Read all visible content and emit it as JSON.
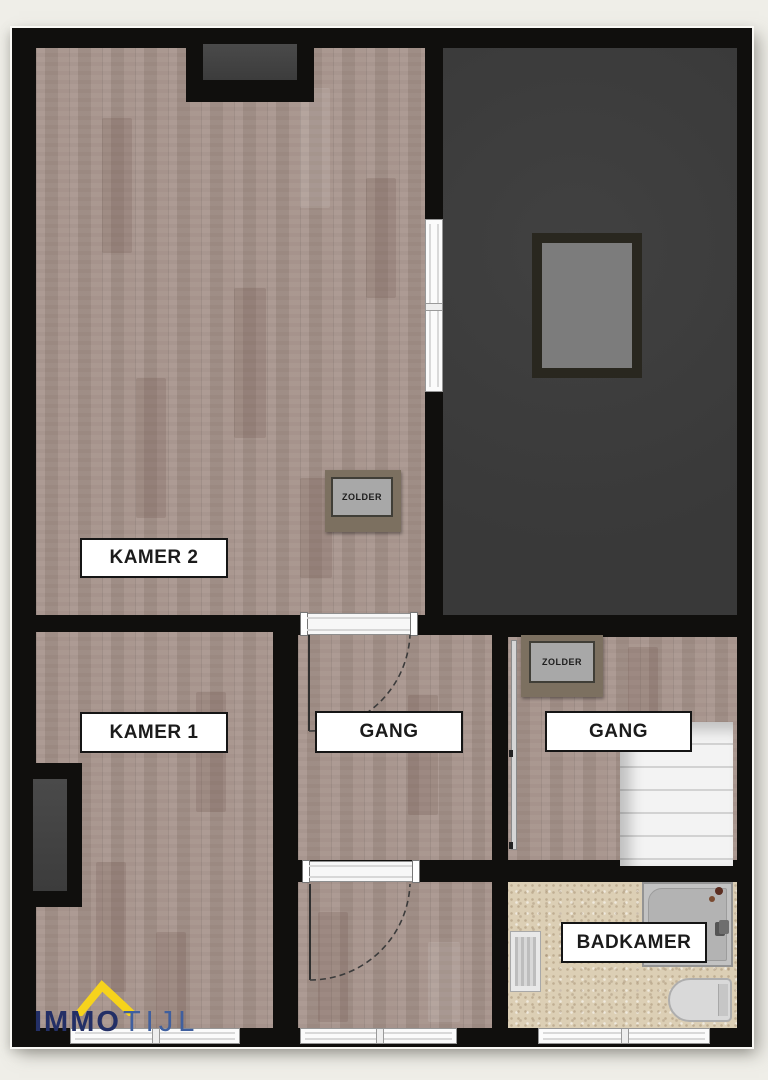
{
  "plan": {
    "rooms": {
      "kamer2": {
        "label": "KAMER 2"
      },
      "kamer1": {
        "label": "KAMER 1"
      },
      "gang_left": {
        "label": "GANG"
      },
      "gang_right": {
        "label": "GANG"
      },
      "badkamer": {
        "label": "BADKAMER"
      }
    },
    "hatches": {
      "left": {
        "label": "ZOLDER"
      },
      "right": {
        "label": "ZOLDER"
      }
    }
  },
  "logo": {
    "immo": "IMMO",
    "tijl": "TIJL"
  },
  "colors": {
    "wall": "#100f0d",
    "wood_floor": "#a6938b",
    "attic_floor": "#3c3c3c",
    "bathroom_floor": "#dccfb5",
    "stairs": "#f3f3f3",
    "hatch_outer": "#7c7060",
    "hatch_inner": "#a8a8a8",
    "logo_navy": "#232f66",
    "logo_blue": "#3f5f9f",
    "logo_yellow": "#f6d31c"
  }
}
